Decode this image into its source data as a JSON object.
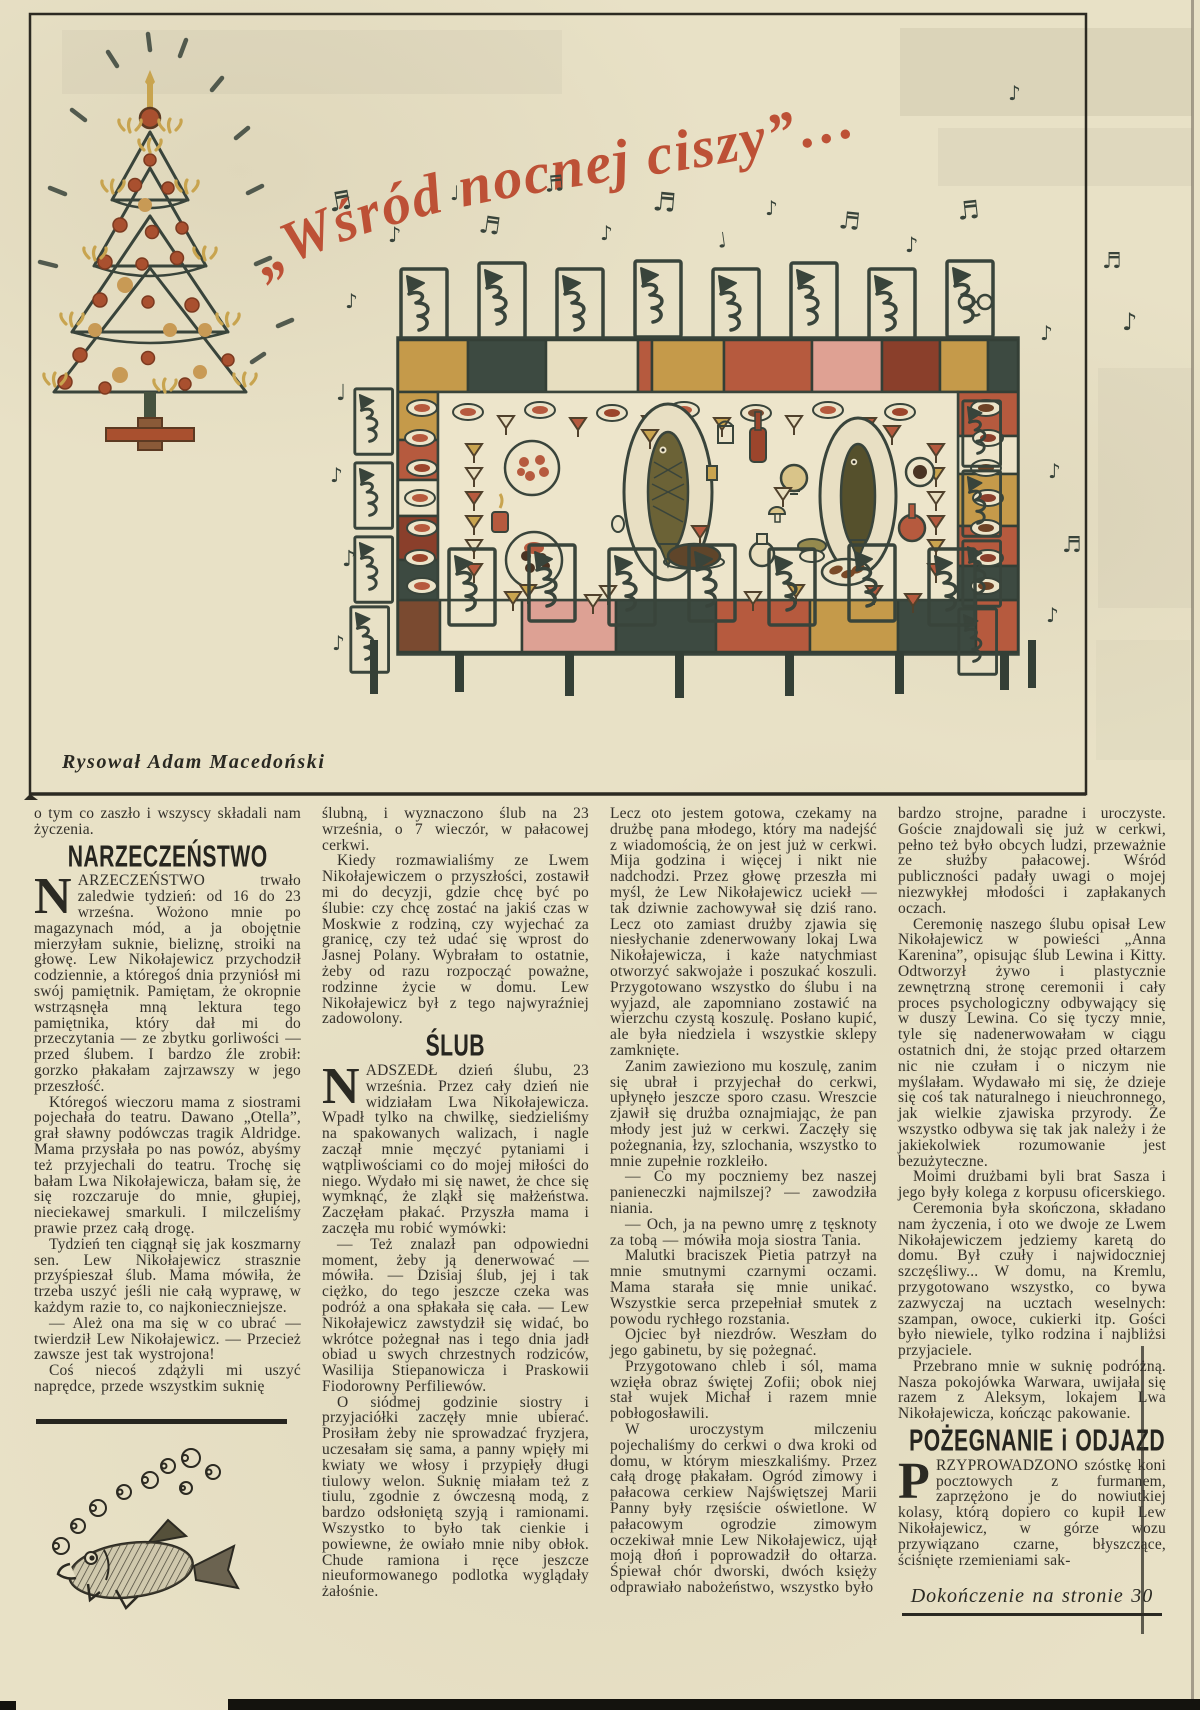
{
  "illustration": {
    "title": "„Wśród nocnej ciszy”…",
    "caption": "Rysował Adam Macedoński",
    "icons": {
      "note_single": "♪",
      "note_beamed": "♬",
      "note_quarter": "♩"
    }
  },
  "colors": {
    "paper": "#e8e1c6",
    "ink": "#33302a",
    "script_red": "#bd5136",
    "illustration_ink": "#39443b",
    "gold": "#c9a44f",
    "terracotta": "#b65a3e",
    "pink": "#dfa193",
    "dark_green": "#3d4a41"
  },
  "article": {
    "col1": {
      "continued": "o tym co zaszło i wszyscy składali nam życzenia.",
      "heading": "NARZECZEŃSTWO",
      "drop_initial": "N",
      "drop_rest": "ARZECZEŃSTWO trwało zaledwie tydzień: od 16 do 23 wrześna. Wożono mnie po magazynach mód, a ja obojętnie mierzyłam suknie, bieliznę, stroiki na głowę. Lew Nikołajewicz przychodził codziennie, a któregoś dnia przyniósł mi swój pamiętnik. Pamiętam, że okropnie wstrząsnęła mną lektura tego pamiętnika, który dał mi do przeczytania — ze zbytku gorliwości — przed ślubem. I bardzo źle zrobił: gorzko płakałam zajrzawszy w jego przeszłość.",
      "paras": [
        "Któregoś wieczoru mama z siostrami pojechała do teatru. Dawano „Otella”, grał sławny podówczas tragik Aldridge. Mama przysłała po nas powóz, abyśmy też przyjechali do teatru. Trochę się bałam Lwa Nikołajewicza, bałam się, że się rozczaruje do mnie, głupiej, nieciekawej smarkuli. I milczeliśmy prawie przez całą drogę.",
        "Tydzień ten ciągnął się jak koszmarny sen. Lew Nikołajewicz strasznie przyśpieszał ślub. Mama mówiła, że trzeba uszyć jeśli nie całą wyprawę, w każdym razie to, co najkonieczniejsze.",
        "— Ależ ona ma się w co ubrać — twierdził Lew Nikołajewicz. — Przecież zawsze jest tak wystrojona!",
        "Coś niecoś zdążyli mi uszyć naprędce, przede wszystkim suknię"
      ]
    },
    "col2": {
      "paras_top": [
        "ślubną, i wyznaczono ślub na 23 września, o 7 wieczór, w pałacowej cerkwi.",
        "Kiedy rozmawialiśmy ze Lwem Nikołajewiczem o przyszłości, zostawił mi do decyzji, gdzie chcę być po ślubie: czy chcę zostać na jakiś czas w Moskwie z rodziną, czy wyjechać za granicę, czy też udać się wprost do Jasnej Polany. Wybrałam to ostatnie, żeby od razu rozpocząć poważne, rodzinne życie w domu. Lew Nikołajewicz był z tego najwyraźniej zadowolony."
      ],
      "heading": "ŚLUB",
      "drop_initial": "N",
      "drop_rest": "ADSZEDŁ dzień ślubu, 23 września. Przez cały dzień nie widziałam Lwa Nikołajewicza. Wpadł tylko na chwilkę, siedzieliśmy na spakowanych walizach, i nagle zaczął mnie męczyć pytaniami i wątpliwościami co do mojej miłości do niego. Wydało mi się nawet, że chce się wymknąć, że zląkł się małżeństwa. Zaczęłam płakać. Przyszła mama i zaczęła mu robić wymówki:",
      "paras": [
        "— Też znalazł pan odpowiedni moment, żeby ją denerwować — mówiła. — Dzisiaj ślub, jej i tak ciężko, do tego jeszcze czeka was podróż a ona spłakała się cała. — Lew Nikołajewicz zawstydził się widać, bo wkrótce pożegnał nas i tego dnia jadł obiad u swych chrzestnych rodziców, Wasilija Stiepanowicza i Praskowii Fiodorowny Perfiliewów.",
        "O siódmej godzinie siostry i przyjaciółki zaczęły mnie ubierać. Prosiłam żeby nie sprowadzać fryzjera, uczesałam się sama, a panny wpięły mi kwiaty we włosy i przypięły długi tiulowy welon. Suknię miałam też z tiulu, zgodnie z ówczesną modą, z bardzo odsłoniętą szyją i ramionami. Wszystko to było tak cienkie i powiewne, że owiało mnie niby obłok. Chude ramiona i ręce jeszcze nieuformowanego podlotka wyglądały żałośnie."
      ]
    },
    "col3": {
      "paras": [
        "Lecz oto jestem gotowa, czekamy na drużbę pana młodego, który ma nadejść z wiadomością, że on jest już w cerkwi. Mija godzina i więcej i nikt nie nadchodzi. Przez głowę przeszła mi myśl, że Lew Nikołajewicz uciekł — tak dziwnie zachowywał się dziś rano. Lecz oto zamiast drużby zjawia się niesłychanie zdenerwowany lokaj Lwa Nikołajewicza, i każe natychmiast otworzyć sakwojaże i poszukać koszuli. Przygotowano wszystko do ślubu i na wyjazd, ale zapomniano zostawić na wierzchu czystą koszulę. Posłano kupić, ale była niedziela i wszystkie sklepy zamknięte.",
        "Zanim zawieziono mu koszulę, zanim się ubrał i przyjechał do cerkwi, upłynęło jeszcze sporo czasu. Wreszcie zjawił się drużba oznajmiając, że pan młody jest już w cerkwi. Zaczęły się pożegnania, łzy, szlochania, wszystko to mnie zupełnie rozkleiło.",
        "— Co my poczniemy bez naszej panieneczki najmilszej? — zawodziła niania.",
        "— Och, ja na pewno umrę z tęsknoty za tobą — mówiła moja siostra Tania.",
        "Malutki braciszek Pietia patrzył na mnie smutnymi czarnymi oczami. Mama starała się mnie unikać. Wszystkie serca przepełniał smutek z powodu rychłego rozstania.",
        "Ojciec był niezdrów. Weszłam do jego gabinetu, by się pożegnać.",
        "Przygotowano chleb i sól, mama wzięła obraz świętej Zofii; obok niej stał wujek Michał i razem mnie pobłogosławili.",
        "W uroczystym milczeniu pojechaliśmy do cerkwi o dwa kroki od domu, w którym mieszkaliśmy. Przez całą drogę płakałam. Ogród zimowy i pałacowa cerkiew Najświętszej Marii Panny były rzęsiście oświetlone. W pałacowym ogrodzie zimowym oczekiwał mnie Lew Nikołajewicz, ujął moją dłoń i poprowadził do ołtarza. Śpiewał chór dworski, dwóch księży odprawiało nabożeństwo, wszystko było"
      ]
    },
    "col4": {
      "paras_top": [
        "bardzo strojne, paradne i uroczyste. Goście znajdowali się już w cerkwi, pełno też było obcych ludzi, przeważnie ze służby pałacowej. Wśród publiczności padały uwagi o mojej niezwykłej młodości i zapłakanych oczach.",
        "Ceremonię naszego ślubu opisał Lew Nikołajewicz w powieści „Anna Karenina”, opisując ślub Lewina i Kitty. Odtworzył żywo i plastycznie zewnętrzną stronę ceremonii i cały proces psychologiczny odbywający się w duszy Lewina. Co się tyczy mnie, tyle się nadenerwowałam w ciągu ostatnich dni, że stojąc przed ołtarzem nic nie czułam i o niczym nie myślałam. Wydawało mi się, że dzieje się coś tak naturalnego i nieuchronnego, jak wielkie zjawiska przyrody. Że wszystko odbywa się tak jak należy i że jakiekolwiek rozumowanie jest bezużyteczne.",
        "Moimi drużbami byli brat Sasza i jego były kolega z korpusu oficerskiego.",
        "Ceremonia była skończona, składano nam życzenia, i oto we dwoje ze Lwem Nikołajewiczem jedziemy karetą do domu. Był czuły i najwidoczniej szczęśliwy... W domu, na Kremlu, przygotowano wszystko, co bywa zazwyczaj na ucztach weselnych: szampan, owoce, cukierki itp. Gości było niewiele, tylko rodzina i najbliżsi przyjaciele.",
        "Przebrano mnie w suknię podróżną. Nasza pokojówka Warwara, uwijała się razem z Aleksym, lokajem Lwa Nikołajewicza, kończąc pakowanie."
      ],
      "heading": "POŻEGNANIE i ODJAZD",
      "drop_initial": "P",
      "drop_rest": "RZYPROWADZONO szóstkę koni pocztowych z furmanem, zaprzężono je do nowiutkiej kolasy, którą dopiero co kupił Lew Nikołajewicz, w górze wozu przywiązano czarne, błyszczące, ściśnięte rzemieniami sak-",
      "footer": "Dokończenie na stronie 30"
    }
  }
}
